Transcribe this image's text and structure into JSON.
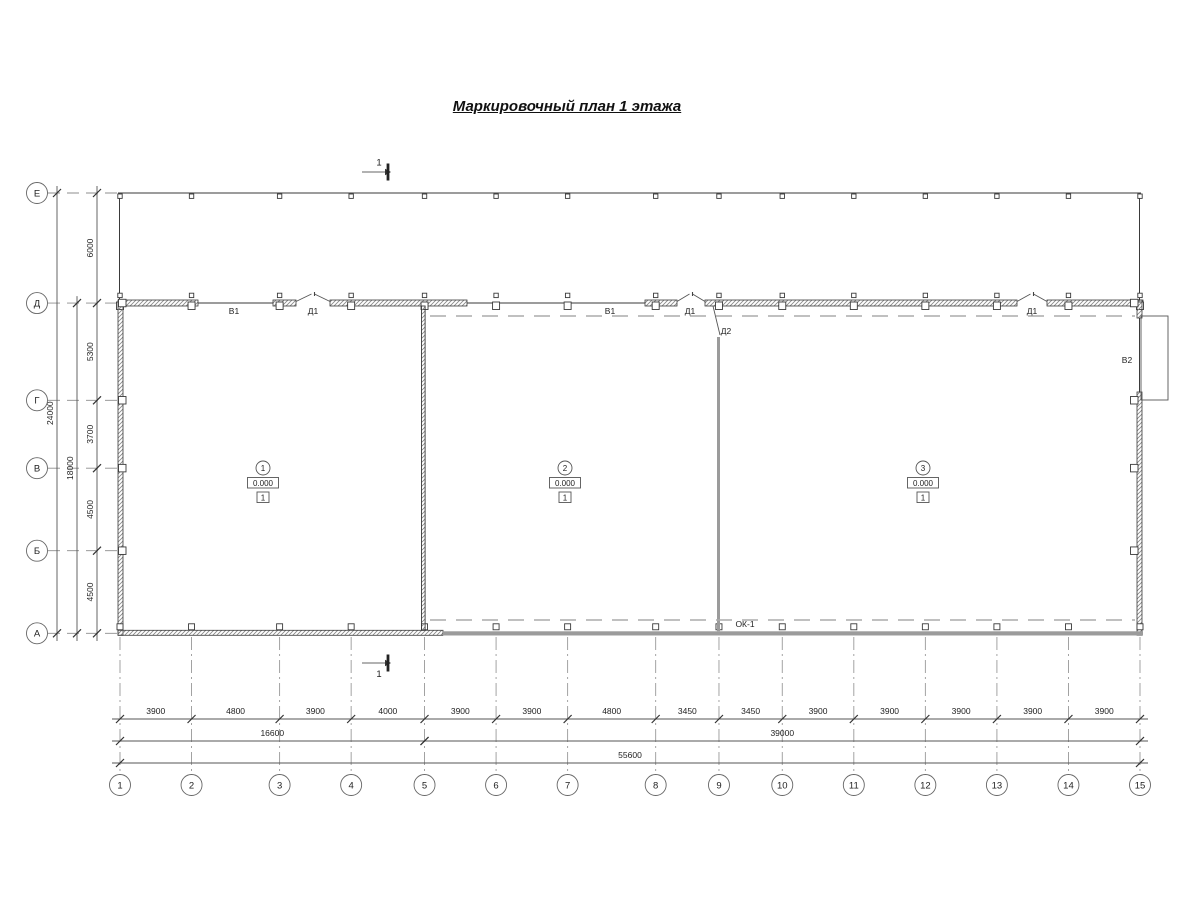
{
  "drawing": {
    "title": "Маркировочный план 1 этажа",
    "section_mark": "1"
  },
  "axes": {
    "row_labels": [
      "Е",
      "Д",
      "Г",
      "В",
      "Б",
      "А"
    ],
    "row_span_mm": [
      6000,
      5300,
      3700,
      4500,
      4500
    ],
    "row_subtotal": {
      "label": "18000",
      "from_row": 1,
      "to_row": 5
    },
    "row_total": {
      "label": "24000",
      "from_row": 0,
      "to_row": 5
    },
    "col_labels": [
      "1",
      "2",
      "3",
      "4",
      "5",
      "6",
      "7",
      "8",
      "9",
      "10",
      "11",
      "12",
      "13",
      "14",
      "15"
    ],
    "col_span_mm": [
      3900,
      4800,
      3900,
      4000,
      3900,
      3900,
      4800,
      3450,
      3450,
      3900,
      3900,
      3900,
      3900,
      3900
    ],
    "col_subtotals": [
      {
        "label": "16600",
        "from_col": 0,
        "to_col": 4
      },
      {
        "label": "39000",
        "from_col": 4,
        "to_col": 14
      }
    ],
    "col_total": {
      "label": "55600",
      "from_col": 0,
      "to_col": 14
    }
  },
  "rooms": [
    {
      "number": "1",
      "elevation": "0.000",
      "floor_type": "1"
    },
    {
      "number": "2",
      "elevation": "0.000",
      "floor_type": "1"
    },
    {
      "number": "3",
      "elevation": "0.000",
      "floor_type": "1"
    }
  ],
  "opening_marks": [
    {
      "text": "В1",
      "x": 234,
      "y": 314
    },
    {
      "text": "Д1",
      "x": 313,
      "y": 314
    },
    {
      "text": "В1",
      "x": 610,
      "y": 314
    },
    {
      "text": "Д1",
      "x": 690,
      "y": 314
    },
    {
      "text": "Д2",
      "x": 726,
      "y": 334
    },
    {
      "text": "Д1",
      "x": 1032,
      "y": 314
    },
    {
      "text": "В2",
      "x": 1127,
      "y": 363
    },
    {
      "text": "ОК-1",
      "x": 745,
      "y": 627
    }
  ],
  "colors": {
    "line": "#3a3a3a",
    "wall_gray": "#9b9b9b",
    "overhead_dash": "#ababab",
    "grid": "#999999",
    "dim": "#555555",
    "text": "#222222"
  },
  "geometry": {
    "x0": 120,
    "y0": 193,
    "plan_width_px": 1020,
    "room_stamp_x": [
      263,
      565,
      923
    ],
    "d_wall_y": 300,
    "d_wall_h": 6,
    "d_wall_segments": [
      [
        120,
        198
      ],
      [
        273,
        296
      ],
      [
        330,
        467
      ],
      [
        645,
        677
      ],
      [
        705,
        1017
      ],
      [
        1047,
        1143
      ]
    ],
    "d_wall_windows": [
      [
        198,
        273
      ],
      [
        467,
        645
      ]
    ],
    "d_wall_doors": [
      [
        296,
        330
      ],
      [
        677,
        705
      ],
      [
        1017,
        1047
      ]
    ],
    "right_window": {
      "wall_x": 1137,
      "open_y1": 318,
      "open_y2": 392,
      "box": [
        1141,
        316,
        27,
        84
      ]
    },
    "bottom_hatched_end": 443,
    "partition1_x": 421.5,
    "partition2_x": 717,
    "partition2_top": 337,
    "section_x": 381
  }
}
